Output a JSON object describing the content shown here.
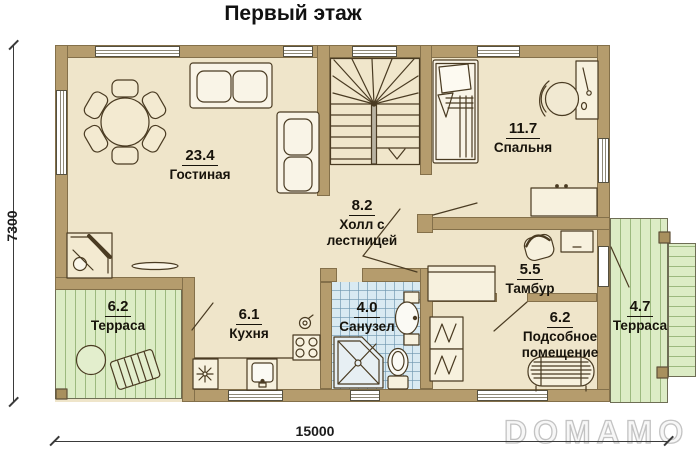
{
  "title": "Первый этаж",
  "watermarks": {
    "center": "ДОМАМО",
    "corner": "DOMAMO"
  },
  "dimensions": {
    "overall_width": "15000",
    "overall_height": "7300"
  },
  "rooms": {
    "living": {
      "area": "23.4",
      "name": "Гостиная"
    },
    "bedroom": {
      "area": "11.7",
      "name": "Спальня"
    },
    "hall": {
      "area": "8.2",
      "name": "Холл с лестницей"
    },
    "tambour": {
      "area": "5.5",
      "name": "Тамбур"
    },
    "kitchen": {
      "area": "6.1",
      "name": "Кухня"
    },
    "bathroom": {
      "area": "4.0",
      "name": "Санузел"
    },
    "utility": {
      "area": "6.2",
      "name": "Подсобное помещение"
    },
    "terrace_left": {
      "area": "6.2",
      "name": "Терраса"
    },
    "terrace_right": {
      "area": "4.7",
      "name": "Терраса"
    }
  },
  "colors": {
    "wall": "#b59c6d",
    "floor": "#efe5ca",
    "terrace": "#dcecc5",
    "terrace_stripe": "#9cb97e",
    "tile": "#d9eaf2",
    "outline": "#4a3b22"
  },
  "icons": [
    "dining-table",
    "sofa",
    "fireplace",
    "staircase",
    "bed",
    "desk",
    "office-chair",
    "dresser",
    "armchair",
    "cabinet",
    "wardrobe",
    "water-heater",
    "boiler-tank",
    "shower",
    "wash-basin",
    "toilet",
    "kitchen-sink",
    "stove",
    "kettle",
    "vent",
    "terrace-table",
    "lounge-chair",
    "post"
  ]
}
